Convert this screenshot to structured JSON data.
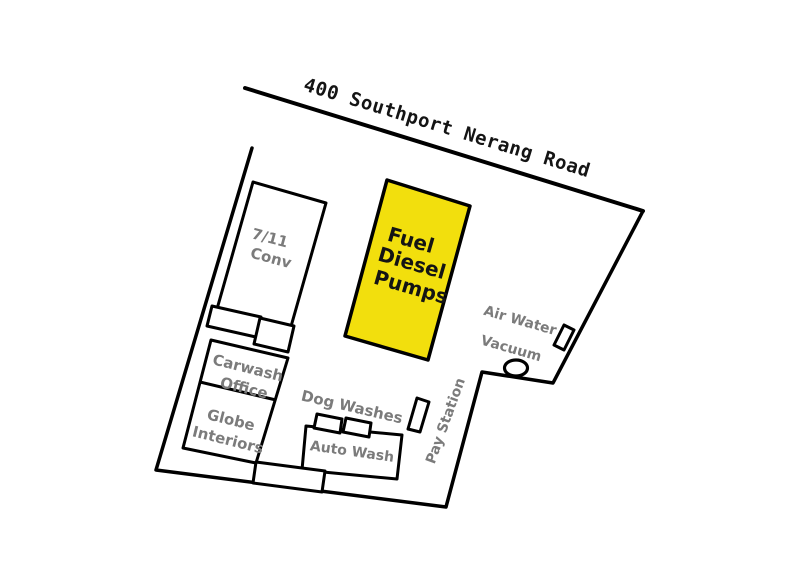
{
  "map": {
    "road_label": "400 Southport Nerang Road",
    "labels": {
      "seven_eleven": [
        "7/11",
        "Conv"
      ],
      "fuel_pumps": [
        "Fuel",
        "Diesel",
        "Pumps"
      ],
      "air_water_vacuum": [
        "Air Water",
        "Vacuum"
      ],
      "carwash_office": [
        "Carwash",
        "Office"
      ],
      "globe_interiors": [
        "Globe",
        "Interiors"
      ],
      "dog_washes": "Dog Washes",
      "auto_wash": "Auto Wash",
      "pay_station": "Pay Station"
    },
    "colors": {
      "fuel_fill": "#F2DF0D",
      "label_gray": "#7B7B7B",
      "ink": "#141414"
    }
  }
}
